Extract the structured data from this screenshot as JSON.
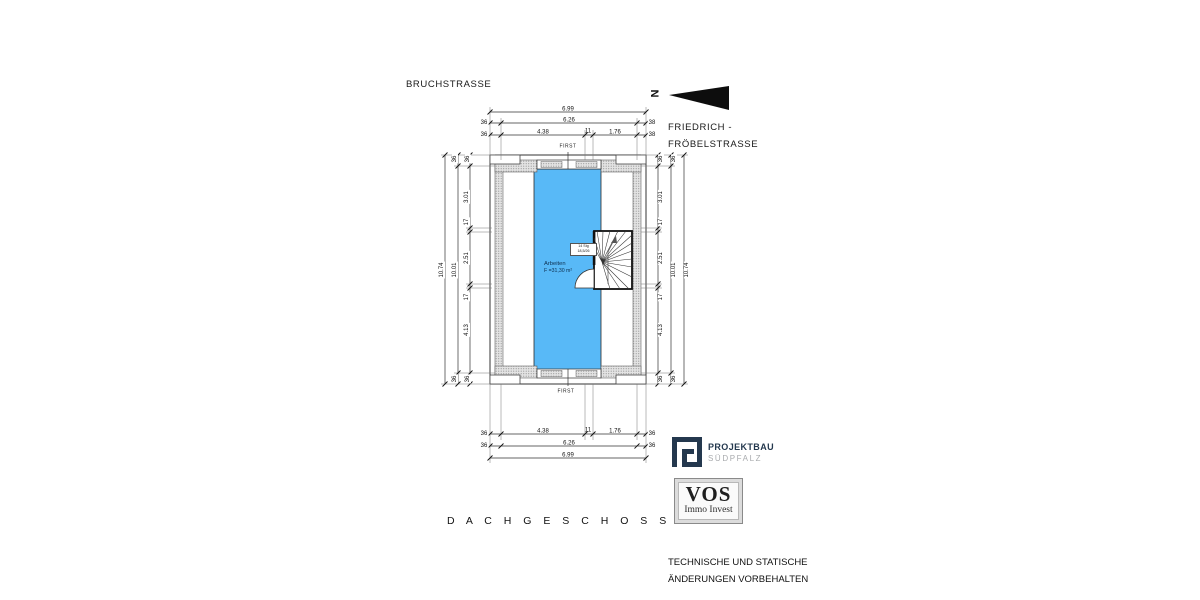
{
  "streets": {
    "top": "BRUCHSTRASSE",
    "right_line1": "FRIEDRICH -",
    "right_line2": "FRÖBELSTRASSE"
  },
  "north_label": "N",
  "floor_label": "D A C H G E S C H O S S",
  "ridge": {
    "top": "FIRST",
    "bottom": "FIRST"
  },
  "room": {
    "name": "Arbeiten",
    "area": "F =31,30 m²",
    "fill": "#58b9f7"
  },
  "stair": {
    "note_line1": "14 Stg",
    "note_line2": "18,5/26"
  },
  "dims": {
    "top": {
      "outer": "6.99",
      "mid": [
        "36",
        "6.26",
        "38"
      ],
      "inner": [
        "36",
        "4.38",
        "11",
        "1.76",
        "38"
      ]
    },
    "bottom": {
      "inner": [
        "36",
        "4.38",
        "11",
        "1.76",
        "36"
      ],
      "mid": [
        "36",
        "6.26",
        "36"
      ],
      "outer": "6.99"
    },
    "left": {
      "outer": "10.74",
      "inner": "10.01",
      "edge_top": [
        "36",
        "36"
      ],
      "segments": [
        "3.01",
        "17",
        "2.51",
        "17",
        "4.13"
      ],
      "edge_bottom": [
        "36",
        "36"
      ]
    },
    "right": {
      "outer": "10.74",
      "inner": "10.01",
      "edge_top": [
        "36",
        "36"
      ],
      "segments": [
        "3.01",
        "17",
        "2.51",
        "17",
        "4.13"
      ],
      "edge_bottom": [
        "36",
        "36"
      ]
    }
  },
  "logos": {
    "projektbau": {
      "title": "PROJEKTBAU",
      "subtitle": "SÜDPFALZ",
      "color": "#24384e",
      "subtitle_color": "#a9abae"
    },
    "vos": {
      "title": "VOS",
      "subtitle": "Immo Invest"
    }
  },
  "disclaimer": {
    "line1": "TECHNISCHE UND STATISCHE",
    "line2": "ÄNDERUNGEN VORBEHALTEN"
  }
}
